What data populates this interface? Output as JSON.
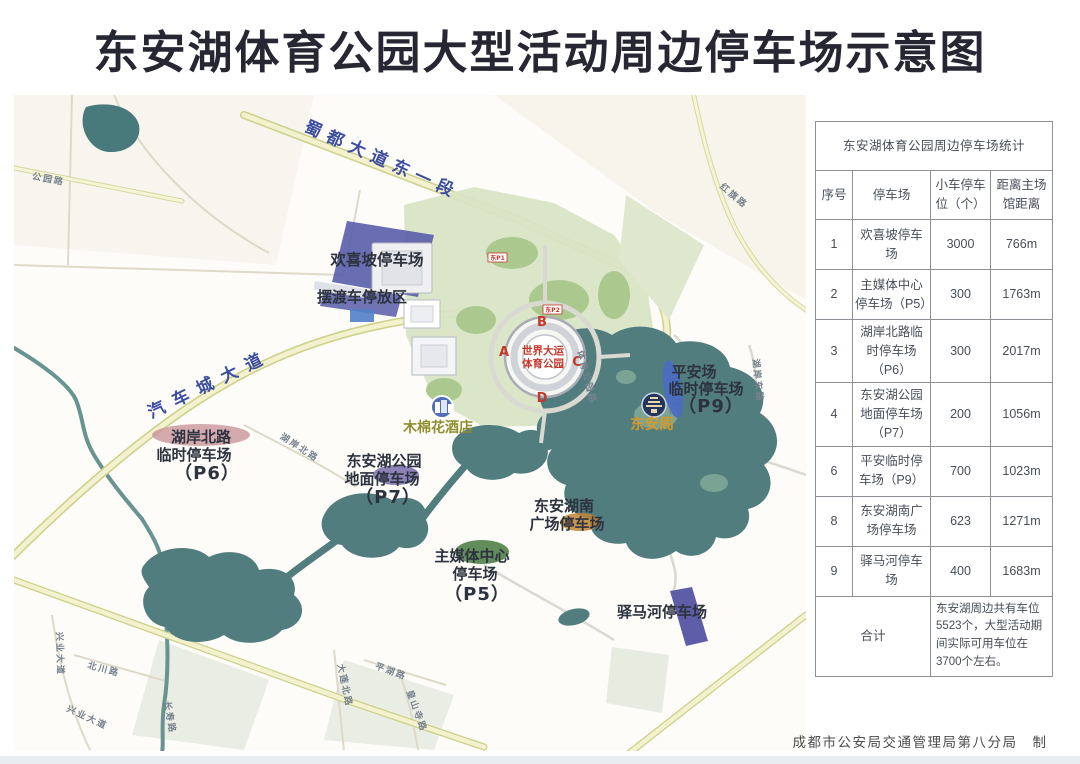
{
  "title": "东安湖体育公园大型活动周边停车场示意图",
  "credit": "成都市公安局交通管理局第八分局　制",
  "table": {
    "title": "东安湖体育公园周边停车场统计",
    "headers": [
      "序号",
      "停车场",
      "小车停车位（个）",
      "距离主场馆距离"
    ],
    "rows": [
      {
        "no": "1",
        "name": "欢喜坡停车场",
        "spaces": "3000",
        "distance": "766m"
      },
      {
        "no": "2",
        "name": "主媒体中心停车场（P5）",
        "spaces": "300",
        "distance": "1763m"
      },
      {
        "no": "3",
        "name": "湖岸北路临时停车场（P6）",
        "spaces": "300",
        "distance": "2017m"
      },
      {
        "no": "4",
        "name": "东安湖公园地面停车场（P7）",
        "spaces": "200",
        "distance": "1056m"
      },
      {
        "no": "6",
        "name": "平安临时停车场（P9）",
        "spaces": "700",
        "distance": "1023m"
      },
      {
        "no": "8",
        "name": "东安湖南广场停车场",
        "spaces": "623",
        "distance": "1271m"
      },
      {
        "no": "9",
        "name": "驿马河停车场",
        "spaces": "400",
        "distance": "1683m"
      }
    ],
    "total_label": "合计",
    "total_note": "东安湖周边共有车位5523个，大型活动期间实际可用车位在3700个左右。"
  },
  "map": {
    "roads_major": [
      "蜀都大道东一段",
      "汽车城大道"
    ],
    "roads_minor": [
      "公园路",
      "红旗路",
      "湖岸北路",
      "湖岸东路",
      "东安湖路",
      "体育公园路",
      "兴业大道",
      "兴业大道",
      "北川路",
      "长寿路",
      "大莲北路",
      "平湖路",
      "皇山寺路"
    ],
    "parking": {
      "huanxipo": "欢喜坡停车场",
      "baiduche": "摆渡车停放区",
      "p6": [
        "湖岸北路",
        "临时停车场",
        "（P6）"
      ],
      "p7": [
        "东安湖公园",
        "地面停车场",
        "（P7）"
      ],
      "p5": [
        "主媒体中心",
        "停车场",
        "（P5）"
      ],
      "south": [
        "东安湖南",
        "广场停车场"
      ],
      "p9": [
        "平安场",
        "临时停车场",
        "（P9）"
      ],
      "yimahe": "驿马河停车场"
    },
    "stadium": {
      "center": [
        "世界大运",
        "体育公园"
      ],
      "gates": [
        "A",
        "B",
        "C",
        "D"
      ],
      "badges": [
        "东P1",
        "东P2"
      ]
    },
    "poi": {
      "hotel": "木棉花酒店",
      "pavilion": "东安阁"
    }
  },
  "colors": {
    "title": "#262732",
    "road_label_blue": "#3c4da0",
    "lake": "#517e80",
    "parking_purple": "#5c61ab",
    "stadium_red": "#c4372b",
    "pavilion_orange": "#d29a2d",
    "hotel_olive": "#8f8f2f"
  }
}
